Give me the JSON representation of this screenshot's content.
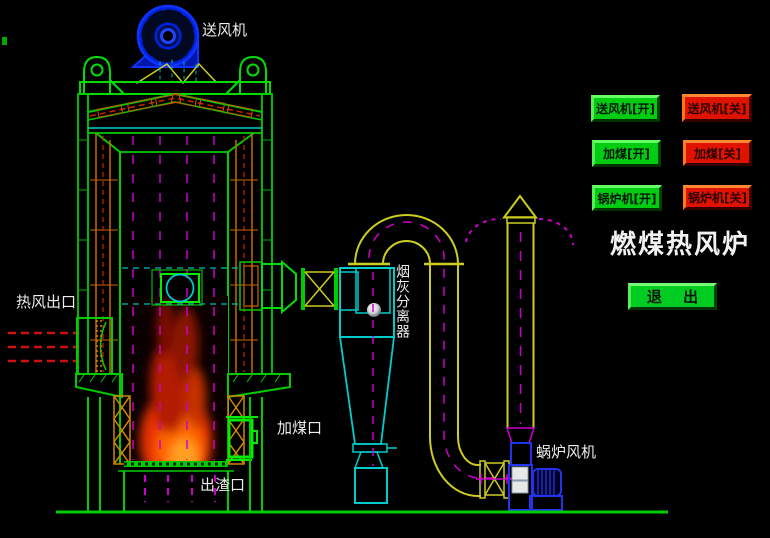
{
  "title": "燃煤热风炉",
  "exit_label": "退 出",
  "buttons": [
    {
      "id": "blower-on",
      "label": "送风机[开]",
      "state": "green"
    },
    {
      "id": "blower-off",
      "label": "送风机[关]",
      "state": "red"
    },
    {
      "id": "coal-on",
      "label": "加煤[开]",
      "state": "green"
    },
    {
      "id": "coal-off",
      "label": "加煤[关]",
      "state": "red"
    },
    {
      "id": "boiler-on",
      "label": "锅炉机[开]",
      "state": "green"
    },
    {
      "id": "boiler-off",
      "label": "锅炉机[关]",
      "state": "red"
    }
  ],
  "labels": {
    "blower": "送风机",
    "hot_air_outlet": "热风出口",
    "ash_separator": "烟灰分离器",
    "coal_inlet": "加煤口",
    "slag_outlet": "出渣口",
    "scroll_fan": "蜗炉风机"
  },
  "colors": {
    "background": "#000000",
    "structure_green": "#00cc00",
    "pipe_yellow": "#cccc22",
    "cyclone_cyan": "#00cccc",
    "flow_magenta": "#cc00cc",
    "arrow_red": "#cc1111",
    "brick_orange": "#cc6600",
    "fan_blue": "#2233ee",
    "button_green": "#00cc11",
    "button_red": "#e01200"
  }
}
